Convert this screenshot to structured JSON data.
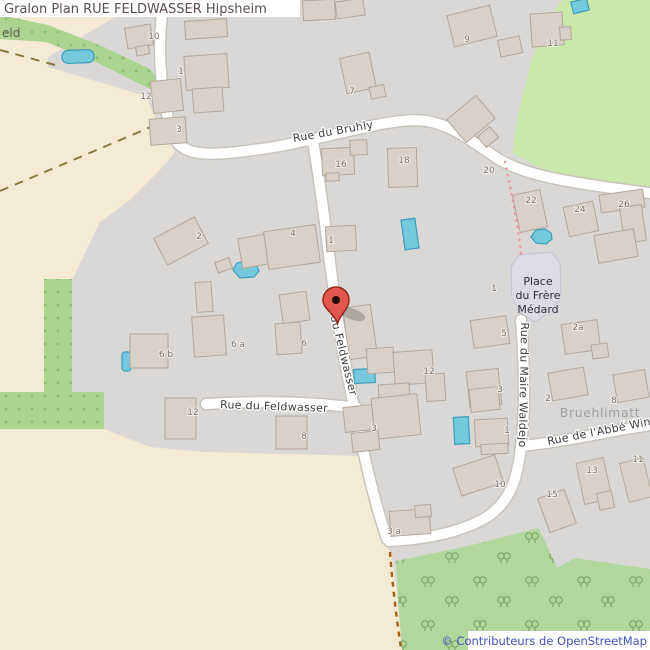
{
  "title": "Gralon Plan RUE FELDWASSER Hipsheim",
  "attribution": "© Contributeurs de OpenStreetMap",
  "colors": {
    "accent_marker": "#e3584e",
    "marker_border": "#94241c",
    "water": "#74c9dc",
    "building": "#d9d0c9",
    "residential": "#d9d8d6",
    "farmland": "#f5ead3",
    "grass": "#cbe8ab",
    "orchard": "#aad48f",
    "forest": "#b2d79d",
    "place_area": "#dcdce7",
    "road": "#ffffff",
    "path_pink": "#f19999",
    "path_orange": "#a55d18",
    "track": "#8a7840",
    "attribution_link": "#4251bb",
    "title_text": "#5a4f4e"
  },
  "map": {
    "streets": {
      "bruhly": "Rue du Bruhly",
      "feldwasser": "Rue du Feldwasser",
      "waldejo": "Rue du Maire Waldejo",
      "abbe": "Rue de l'Abbé Win"
    },
    "places": {
      "frere_medard": {
        "line1": "Place",
        "line2": "du Frère",
        "line3": "Médard"
      },
      "bruehlimatt": "Bruehlimatt",
      "partial_left": "eld"
    },
    "housenumbers": [
      {
        "text": "10"
      },
      {
        "text": "12"
      },
      {
        "text": "1"
      },
      {
        "text": "3"
      },
      {
        "text": "9"
      },
      {
        "text": "11"
      },
      {
        "text": "7"
      },
      {
        "text": "16"
      },
      {
        "text": "18"
      },
      {
        "text": "20"
      },
      {
        "text": "22"
      },
      {
        "text": "24"
      },
      {
        "text": "26"
      },
      {
        "text": "2"
      },
      {
        "text": "4"
      },
      {
        "text": "1"
      },
      {
        "text": "1"
      },
      {
        "text": "5"
      },
      {
        "text": "2a"
      },
      {
        "text": "3"
      },
      {
        "text": "6 b"
      },
      {
        "text": "6 a"
      },
      {
        "text": "6"
      },
      {
        "text": "12"
      },
      {
        "text": "2"
      },
      {
        "text": "8"
      },
      {
        "text": "12"
      },
      {
        "text": "8"
      },
      {
        "text": "3"
      },
      {
        "text": "1"
      },
      {
        "text": "10"
      },
      {
        "text": "13"
      },
      {
        "text": "15"
      },
      {
        "text": "11"
      },
      {
        "text": "3 a"
      }
    ]
  }
}
